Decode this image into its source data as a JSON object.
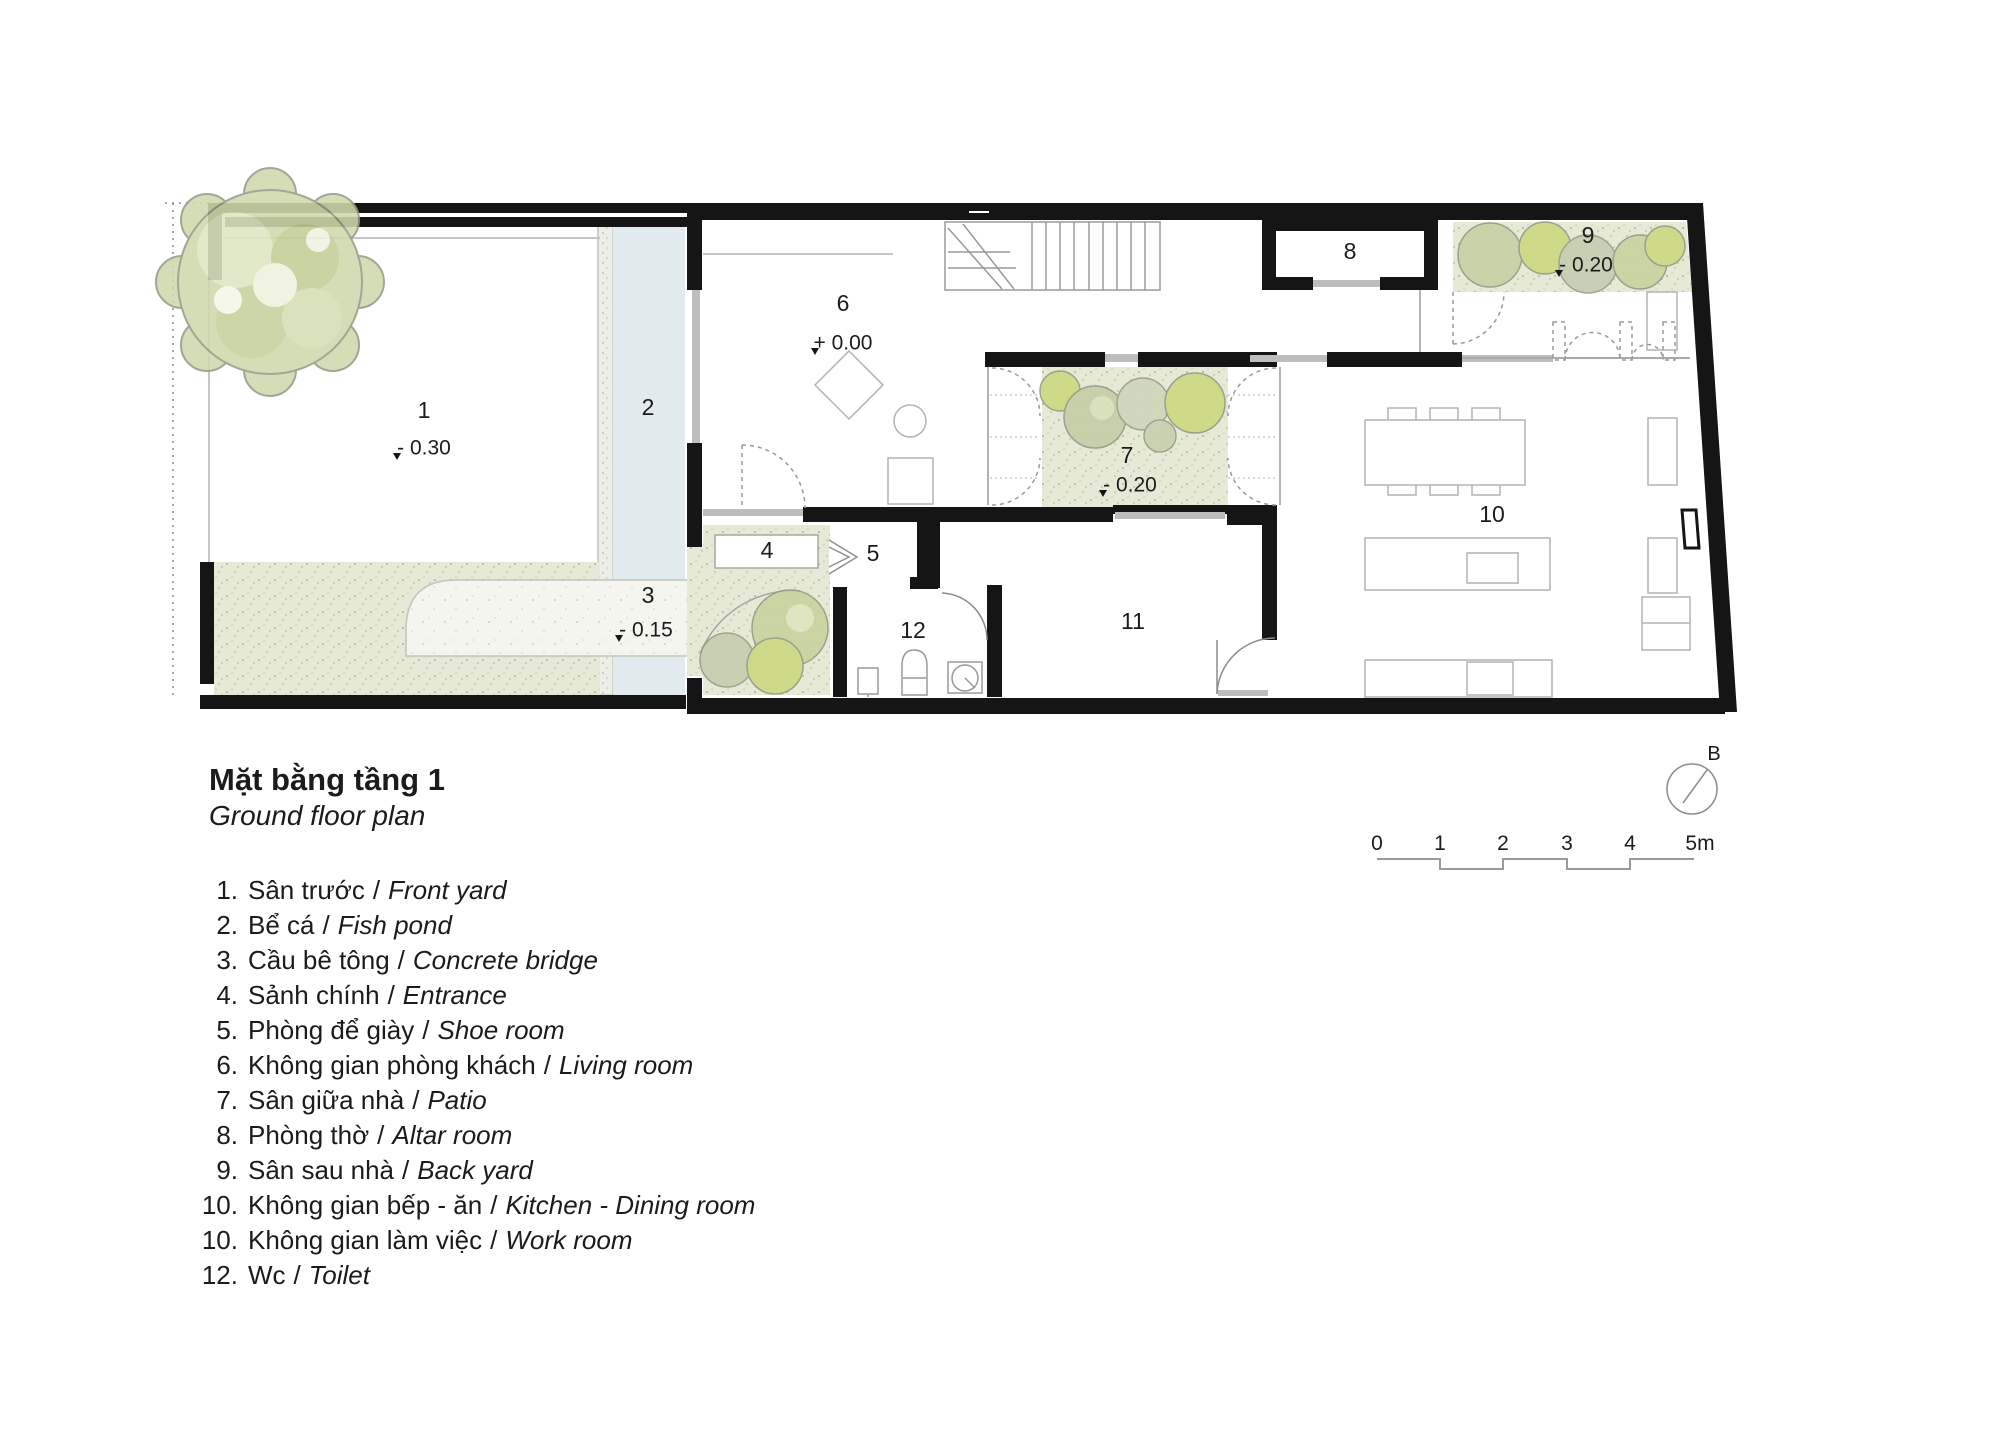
{
  "title": {
    "vi": "Mặt bằng tầng 1",
    "en": "Ground floor plan"
  },
  "ui": {
    "sep": "/"
  },
  "legend": [
    {
      "num": "1.",
      "vi": "Sân trước",
      "en": "Front yard"
    },
    {
      "num": "2.",
      "vi": "Bể cá",
      "en": "Fish pond"
    },
    {
      "num": "3.",
      "vi": "Cầu bê tông",
      "en": "Concrete bridge"
    },
    {
      "num": "4.",
      "vi": "Sảnh chính",
      "en": "Entrance"
    },
    {
      "num": "5.",
      "vi": "Phòng để giày",
      "en": "Shoe room"
    },
    {
      "num": "6.",
      "vi": "Không gian phòng khách",
      "en": "Living room"
    },
    {
      "num": "7.",
      "vi": "Sân giữa nhà",
      "en": "Patio"
    },
    {
      "num": "8.",
      "vi": "Phòng thờ",
      "en": "Altar room"
    },
    {
      "num": "9.",
      "vi": "Sân sau nhà",
      "en": "Back yard"
    },
    {
      "num": "10.",
      "vi": "Không gian bếp - ăn",
      "en": "Kitchen - Dining room"
    },
    {
      "num": "10.",
      "vi": "Không gian làm việc",
      "en": "Work room"
    },
    {
      "num": "12.",
      "vi": "Wc",
      "en": "Toilet"
    }
  ],
  "plan": {
    "rooms": [
      {
        "num": "1",
        "level": "- 0.30"
      },
      {
        "num": "2"
      },
      {
        "num": "3",
        "level": "- 0.15"
      },
      {
        "num": "4"
      },
      {
        "num": "5"
      },
      {
        "num": "6",
        "level": "+ 0.00"
      },
      {
        "num": "7",
        "level": "- 0.20"
      },
      {
        "num": "8"
      },
      {
        "num": "9",
        "level": "- 0.20"
      },
      {
        "num": "10"
      },
      {
        "num": "11"
      },
      {
        "num": "12"
      }
    ]
  },
  "scalebar": {
    "labels": [
      "0",
      "1",
      "2",
      "3",
      "4",
      "5m"
    ]
  },
  "north": {
    "label": "B"
  },
  "colors": {
    "wall": "#151515",
    "grass": "#e6e9d6",
    "water": "#e0eaef",
    "tree_light": "#cfd9ab",
    "tree_bright": "#ccd87f",
    "tree_gray": "#c5cdb0",
    "line_gray": "#999999"
  }
}
